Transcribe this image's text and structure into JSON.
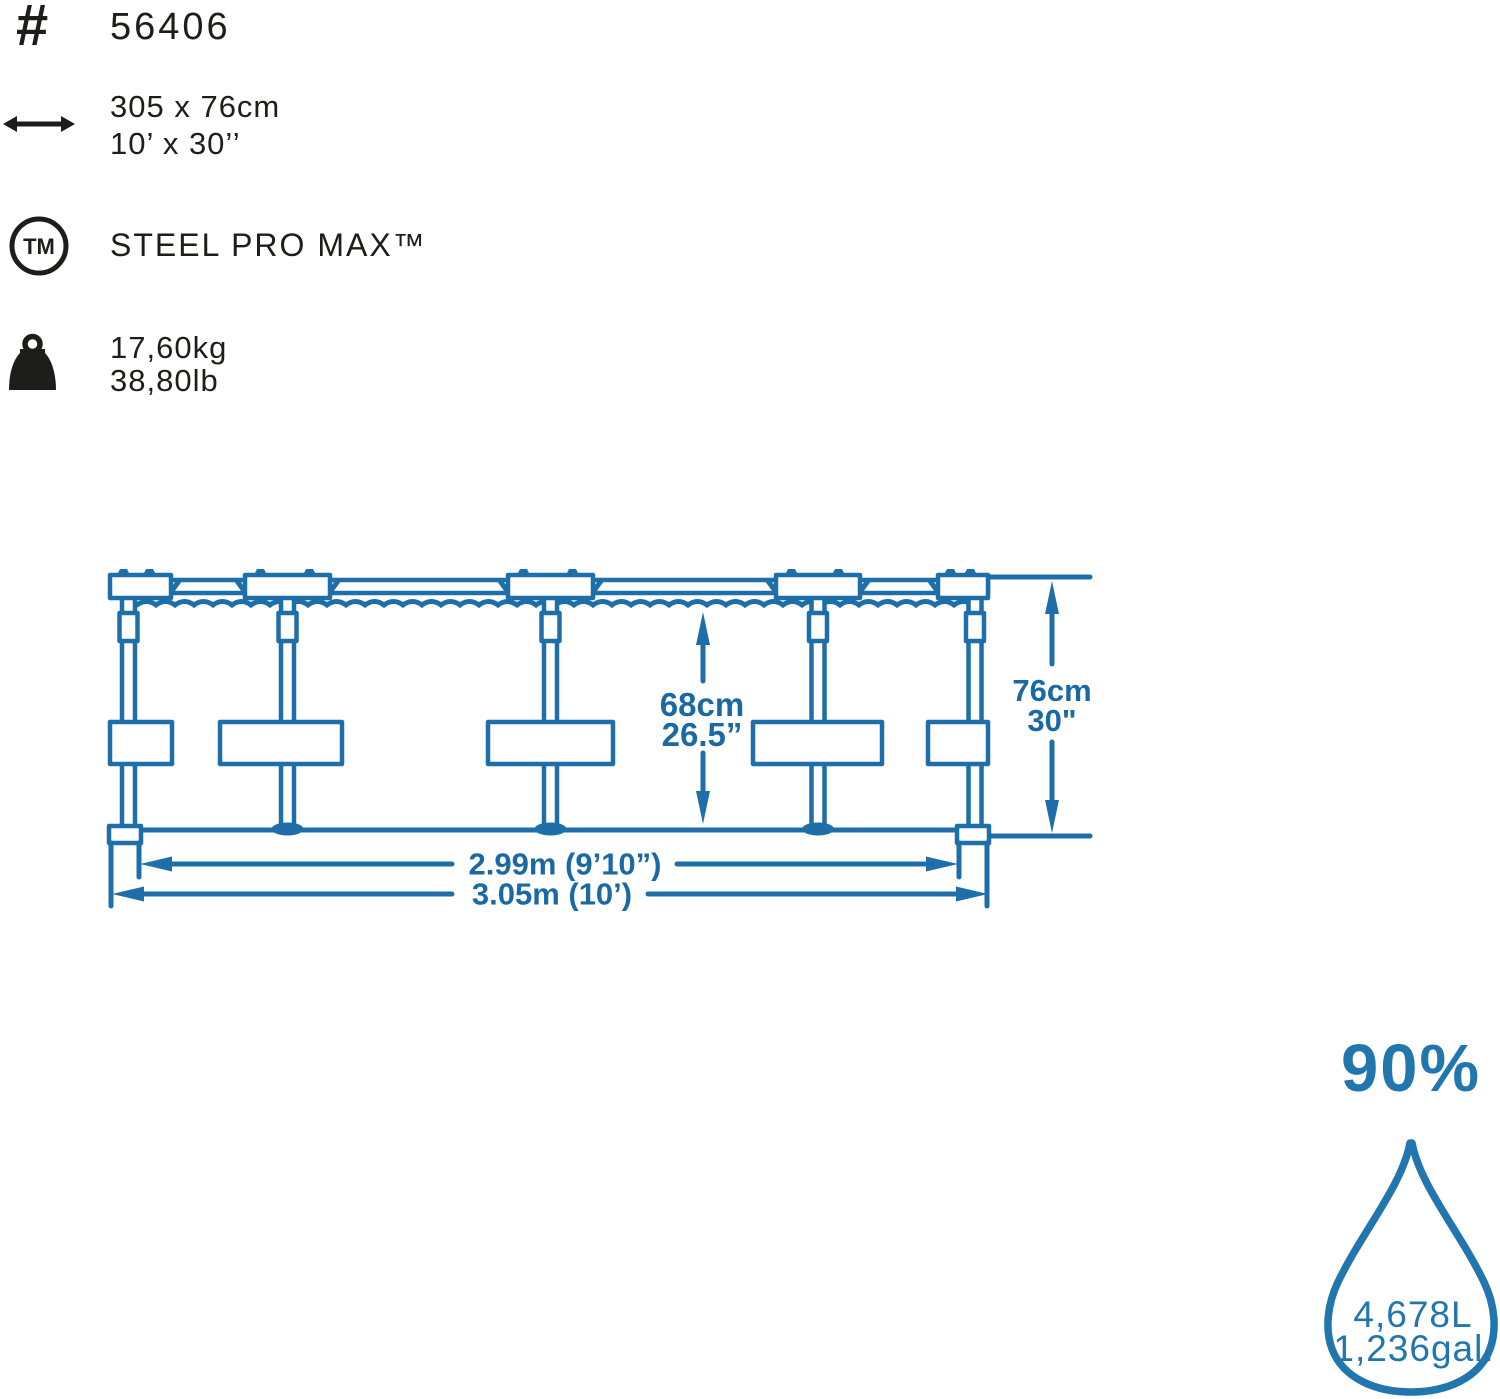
{
  "title": "Steel Pro Max pool specification infographic",
  "colors": {
    "ink": "#1d1d1b",
    "diagram_blue": "#1e6fa9",
    "drop_blue": "#2176ad"
  },
  "specs": {
    "item_number": "56406",
    "size_metric": "305 x 76cm",
    "size_imperial": "10’ x 30’’",
    "brand": "STEEL PRO MAX™",
    "weight_metric": "17,60kg",
    "weight_imperial": "38,80lb"
  },
  "diagram": {
    "water_height_metric": "68cm",
    "water_height_imperial": "26.5”",
    "wall_height_metric": "76cm",
    "wall_height_imperial": "30\"",
    "inner_diameter": "2.99m (9’10”)",
    "outer_diameter": "3.05m (10’)"
  },
  "capacity": {
    "fill_percent": "90%",
    "liters": "4,678L",
    "gallons": "1,236gal."
  }
}
